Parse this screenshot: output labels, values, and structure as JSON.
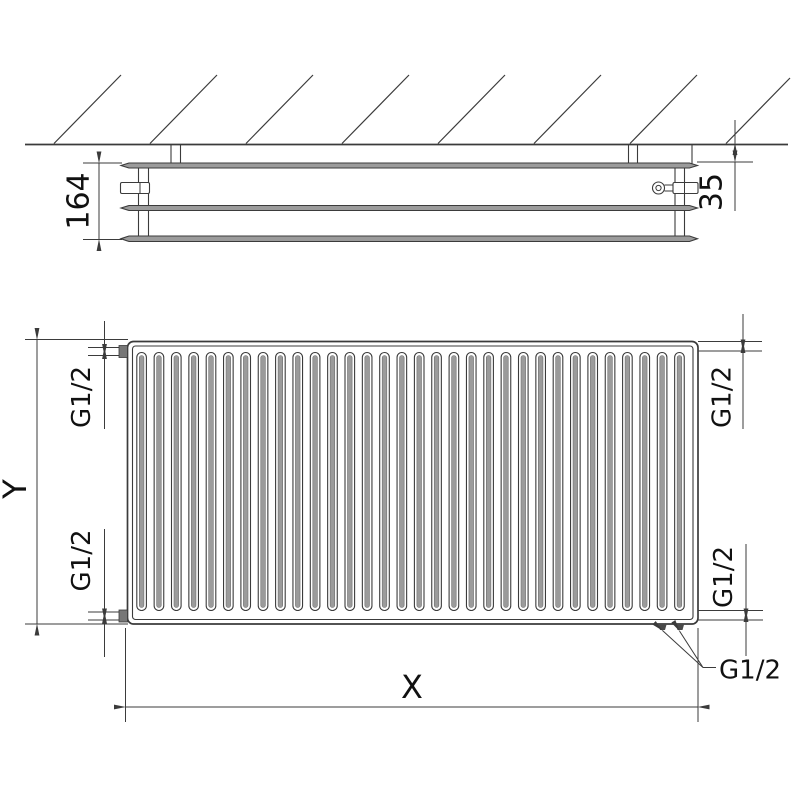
{
  "views": {
    "side_section": {
      "dim_depth": "164",
      "dim_wall_distance": "35"
    },
    "front": {
      "dim_height": "Y",
      "dim_width": "X",
      "thread_top_left": "G1/2",
      "thread_top_right": "G1/2",
      "thread_bottom_left": "G1/2",
      "thread_bottom_right": "G1/2",
      "thread_bottom_callout": "G1/2",
      "fins": {
        "count": 32
      }
    }
  },
  "colors": {
    "line": "#3b3b3b",
    "gray_fill": "#9b9b9b",
    "cap_fill": "#777777",
    "tab_fill": "#4a4a4a",
    "text": "#111111",
    "background": "#ffffff"
  }
}
